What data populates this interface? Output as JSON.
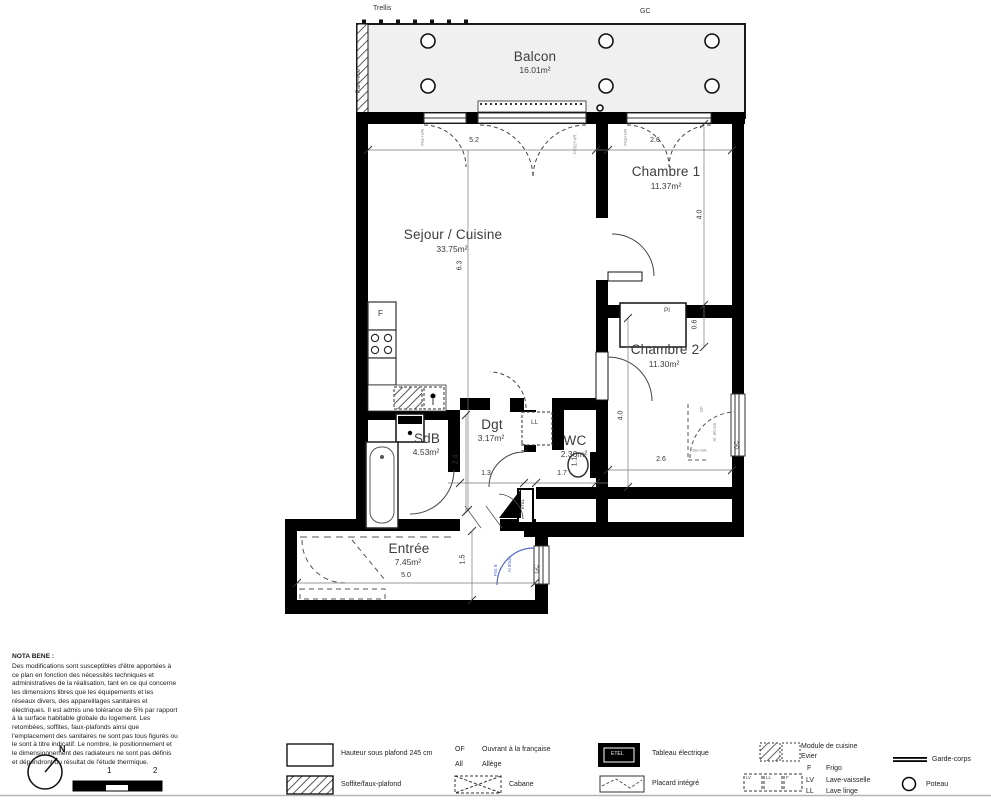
{
  "plan": {
    "balcony": {
      "label": "Balcon",
      "area": "16.01m²",
      "top_left_label": "Trellis",
      "top_right_label": "GC",
      "side_label": "Pare-vue"
    },
    "rooms": [
      {
        "label": "Sejour / Cuisine",
        "area": "33.75m²"
      },
      {
        "label": "Chambre 1",
        "area": "11.37m²"
      },
      {
        "label": "Chambre 2",
        "area": "11.30m²"
      },
      {
        "label": "SdB",
        "area": "4.53m²"
      },
      {
        "label": "Dgt",
        "area": "3.17m²"
      },
      {
        "label": "WC",
        "area": "2.36m²"
      },
      {
        "label": "Entrée",
        "area": "7.45m²"
      }
    ],
    "features": {
      "placard": "Pl",
      "fridge": "F",
      "lave_linge": "LL",
      "tableau": "ETEL",
      "of": "OF"
    },
    "window_codes": {
      "w1": "F01+VR",
      "w2": "PF02+VR",
      "w3": "F03+VR",
      "w4": "F06+VR",
      "w5": "F04 B",
      "allege_1": "Al. 60 cm",
      "allege_2": "Al 60cm"
    },
    "gc_labels": {
      "right": "GC",
      "entree": "GC"
    },
    "dims": {
      "sejour_w": "5.2",
      "ch1_w": "2.6",
      "sejour_h": "6.3",
      "ch1_h": "4.0",
      "placard_d": "0.6",
      "ch2_h": "4.0",
      "ch2_w": "2.6",
      "sdb_h": "2.4",
      "dgt_w": "1.3",
      "dgt_h": "1.7",
      "wc_w": "1.7",
      "wc_d": "1.1",
      "entree_h": "1.5",
      "entree_w": "5.0"
    }
  },
  "nota_bene": {
    "title": "NOTA BENE :",
    "lines": [
      "Des modifications sont susceptibles d'être apportées à",
      "ce plan en fonction des nécessités techniques et",
      "administratives de la réalisation, tant en ce qui concerne",
      "les dimensions libres que les équipements et les",
      "réseaux divers, des appareillages sanitaires et",
      "électriques. Il est admis une tolérance de 5% par rapport",
      "à la surface habitable globale du logement. Les",
      "retombées, soffites, faux-plafonds ainsi que",
      "l'emplacement des sanitaires ne sont pas tous figurés ou",
      "le sont à titre indicatif. Le nombre, le positionnement et",
      "le dimensionnement des radiateurs ne sont pas définis",
      "et dépendront du résultat de l'étude thermique."
    ]
  },
  "legend": {
    "hauteur": "Hauteur sous plafond 245 cm",
    "soffite": "Soffite/faux-plafond",
    "of_abbr": "OF",
    "of": "Ouvrant à la française",
    "all_abbr": "All",
    "all": "Allège",
    "cabane": "Cabane",
    "etel": "ETEL",
    "tableau": "Tableau électrique",
    "placard": "Placard intégré",
    "module": "Module de cuisine",
    "evier": "Evier",
    "f_abbr": "F",
    "frigo": "Frigo",
    "lv_abbr": "LV",
    "lv": "Lave-vaisselle",
    "ll_abbr": "LL",
    "ll": "Lave linge",
    "garde_corps": "Garde-corps",
    "poteau": "Poteau",
    "box_lv": "LV",
    "box_ll": "LL",
    "box_f": "F"
  },
  "compass": {
    "north": "N"
  },
  "scale_bar": {
    "mid": "1",
    "end": "2"
  }
}
